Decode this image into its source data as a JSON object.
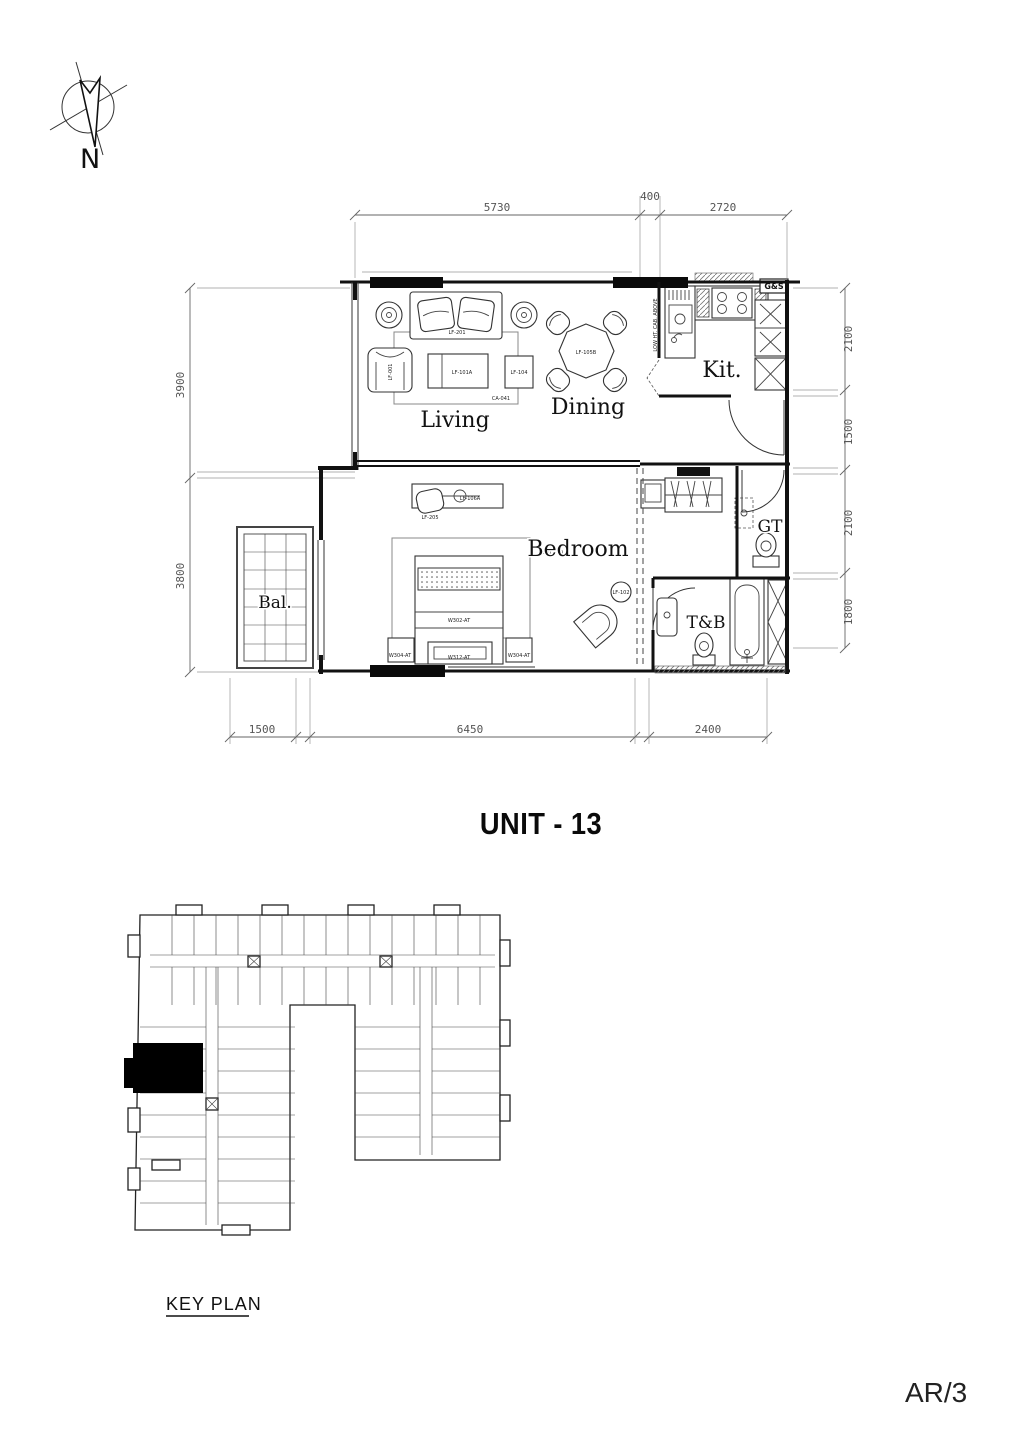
{
  "sheet": {
    "title": "UNIT - 13",
    "number": "AR/3",
    "key_plan_label": "KEY PLAN",
    "north_label": "N"
  },
  "rooms": {
    "living": "Living",
    "dining": "Dining",
    "kitchen": "Kit.",
    "bedroom": "Bedroom",
    "balcony": "Bal.",
    "toilet_bath": "T&B",
    "guest_toilet": "GT"
  },
  "annotations": {
    "gas_meter": "G&S",
    "low_cab": "LOW HT. CAB. ABOVE"
  },
  "tags": {
    "sofa": "LF-201",
    "armchair": "LF-001",
    "coffee_table": "LF-101A",
    "side_table": "LF-104",
    "carpet": "CA-041",
    "dining_table": "LF-105B",
    "console": "LF-106A",
    "desk_chair": "LF-205",
    "corner_chair": "LF-102",
    "bed_center": "W302-AT",
    "window_left": "W304-AT",
    "window_center": "W312-AT",
    "window_right": "W304-AT",
    "rug": "RG-02(W)"
  },
  "dims": {
    "top": [
      "5730",
      "400",
      "2720"
    ],
    "left": [
      "3900",
      "3800"
    ],
    "right": [
      "2100",
      "1500",
      "2100",
      "1800"
    ],
    "bottom": [
      "1500",
      "6450",
      "2400"
    ]
  }
}
